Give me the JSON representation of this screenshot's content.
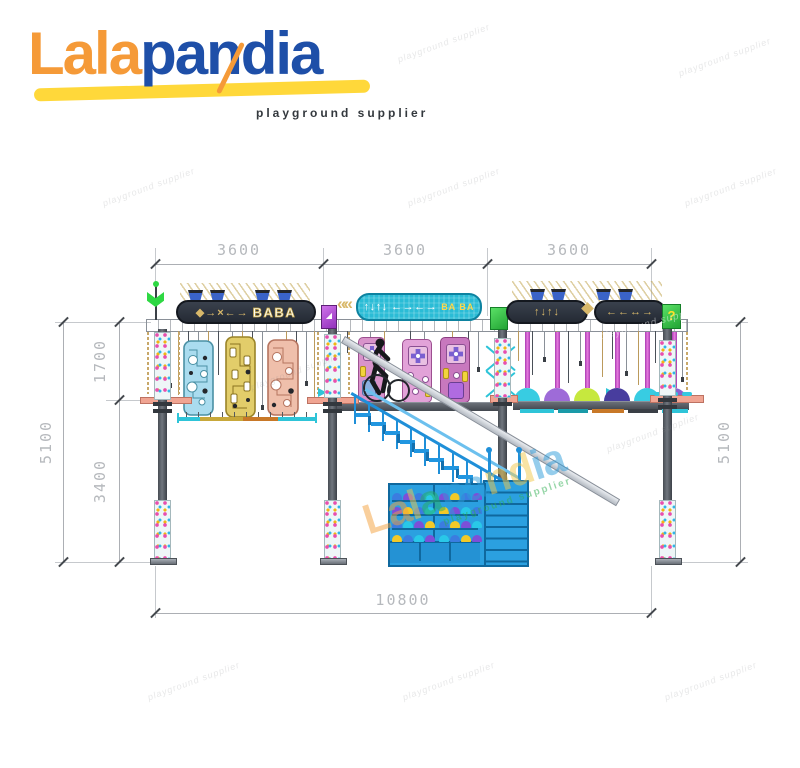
{
  "logo": {
    "brand_orange": "Lala",
    "brand_blue": "pandia",
    "tagline": "playground supplier"
  },
  "dimensions": {
    "top": [
      "3600",
      "3600",
      "3600"
    ],
    "left_upper": "1700",
    "left_lower": "3400",
    "left_total": "5100",
    "right_total": "5100",
    "bottom_total": "10800"
  },
  "signs": {
    "left": {
      "arrows": "◆→×←→",
      "label": "BABA"
    },
    "middle": {
      "chevrons": "««",
      "arrows": "↑↓↑↓ ←→←→",
      "label": "BA BA"
    },
    "right1": {
      "arrows": "↑↓↑↓"
    },
    "right2": {
      "arrows": "←←↔→"
    },
    "cube_question": "?"
  },
  "watermark": {
    "small": "playground supplier",
    "brand_sub": "playground supplier",
    "brand_letters": [
      {
        "ch": "L",
        "color": "#f5a03c"
      },
      {
        "ch": "a",
        "color": "#f5a03c"
      },
      {
        "ch": "l",
        "color": "#f2c94c"
      },
      {
        "ch": "a",
        "color": "#27ae60"
      },
      {
        "ch": "p",
        "color": "#2d9cdb"
      },
      {
        "ch": "a",
        "color": "#2d9cdb"
      },
      {
        "ch": "n",
        "color": "#f2c94c"
      },
      {
        "ch": "d",
        "color": "#f2c94c"
      },
      {
        "ch": "i",
        "color": "#2d9cdb"
      },
      {
        "ch": "a",
        "color": "#2d9cdb"
      }
    ]
  },
  "colors": {
    "brand_orange": "#f59a38",
    "brand_blue": "#1e4fa8",
    "swoosh_yellow": "#ffd83a",
    "dim_text": "#b6b9bd",
    "sign_dark": "#2e3540",
    "sign_gold": "#d8b86a",
    "sign_cyan": "#2abcd6",
    "cube_green": "#3ed64b",
    "cube_purple": "#b44fd8",
    "panel_blue": "#aadcef",
    "panel_gold": "#e2cd6a",
    "panel_salmon": "#efbfab",
    "pink_panel": "#d893ca",
    "stairs_blue": "#2196e0",
    "shelf_blue": "#2ba0e0",
    "rope_cyan": "#2ec4d8",
    "salmon_rail": "#f0a492",
    "dome_colors": [
      "#38cce2",
      "#9e6bd8",
      "#c6e83e",
      "#483d9e",
      "#38cce2",
      "#8a5fd0"
    ],
    "helmet_colors": [
      "#3b7ce0",
      "#7c4fd8",
      "#f2c928",
      "#29c8e8"
    ]
  }
}
